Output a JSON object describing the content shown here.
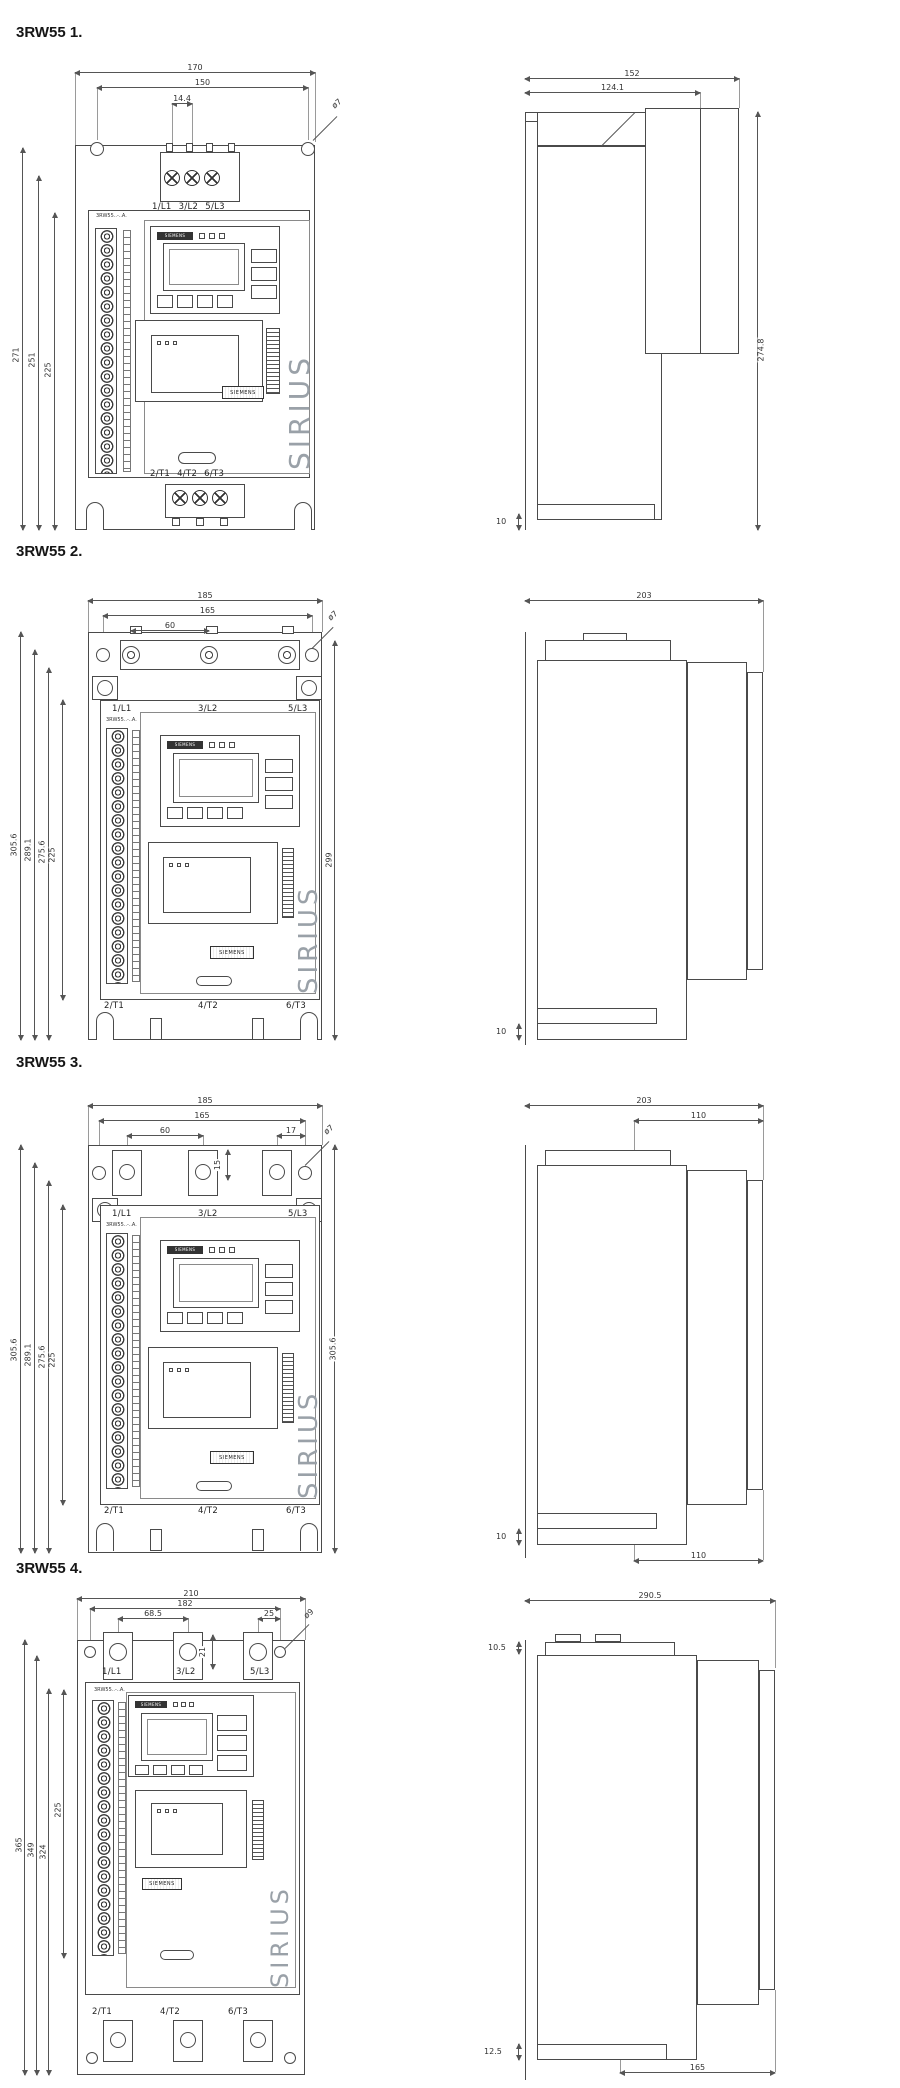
{
  "page": {
    "background": "#ffffff",
    "line_color": "#4a4a4a",
    "dim_text_color": "#333333"
  },
  "drawings": [
    {
      "title": "3RW55 1.",
      "front": {
        "model_label": "3RW55..-..A.",
        "display_brand": "SIEMENS",
        "logo_label": "SIEMENS",
        "product_name": "SIRIUS",
        "top_terminals": [
          "1/L1",
          "3/L2",
          "5/L3"
        ],
        "bottom_terminals": [
          "2/T1",
          "4/T2",
          "6/T3"
        ],
        "dim_width_total": "170",
        "dim_width_holes": "150",
        "dim_terminal_pitch": "14.4",
        "hole_diameter": "ø7",
        "dim_height_total": "271",
        "dim_height_holes": "251",
        "dim_height_body": "225"
      },
      "side": {
        "dim_depth_total": "152",
        "dim_depth_front": "124.1",
        "dim_height": "274.8",
        "dim_foot": "10"
      }
    },
    {
      "title": "3RW55 2.",
      "front": {
        "model_label": "3RW55..-..A.",
        "display_brand": "SIEMENS",
        "logo_label": "SIEMENS",
        "product_name": "SIRIUS",
        "top_terminals": [
          "1/L1",
          "3/L2",
          "5/L3"
        ],
        "bottom_terminals": [
          "2/T1",
          "4/T2",
          "6/T3"
        ],
        "dim_width_total": "185",
        "dim_width_holes": "165",
        "dim_hole_pitch": "60",
        "hole_diameter": "ø7",
        "dim_height_total": "305.6",
        "dim_height_2": "289.1",
        "dim_height_3": "275.6",
        "dim_height_body": "225",
        "dim_height_right": "299"
      },
      "side": {
        "dim_depth_total": "203",
        "dim_foot": "10"
      }
    },
    {
      "title": "3RW55 3.",
      "front": {
        "model_label": "3RW55..-..A.",
        "display_brand": "SIEMENS",
        "logo_label": "SIEMENS",
        "product_name": "SIRIUS",
        "top_terminals": [
          "1/L1",
          "3/L2",
          "5/L3"
        ],
        "bottom_terminals": [
          "2/T1",
          "4/T2",
          "6/T3"
        ],
        "dim_width_total": "185",
        "dim_width_holes": "165",
        "dim_hole_pitch": "60",
        "dim_tab_pitch": "17",
        "dim_tab_depth": "15",
        "hole_diameter": "ø7",
        "dim_height_total": "305.6",
        "dim_height_2": "289.1",
        "dim_height_3": "275.6",
        "dim_height_body": "225",
        "dim_height_right": "305.6"
      },
      "side": {
        "dim_depth_total": "203",
        "dim_depth_front": "110",
        "dim_foot": "10",
        "dim_bottom_front": "110"
      }
    },
    {
      "title": "3RW55 4.",
      "front": {
        "model_label": "3RW55..-..A.",
        "display_brand": "SIEMENS",
        "logo_label": "SIEMENS",
        "product_name": "SIRIUS",
        "top_terminals": [
          "1/L1",
          "3/L2",
          "5/L3"
        ],
        "bottom_terminals": [
          "2/T1",
          "4/T2",
          "6/T3"
        ],
        "dim_width_total": "210",
        "dim_width_holes": "182",
        "dim_hole_pitch": "68.5",
        "dim_tab_pitch": "25",
        "dim_tab_depth": "21",
        "hole_diameter": "ø9",
        "dim_height_total": "365",
        "dim_height_2": "349",
        "dim_height_3": "324",
        "dim_height_body": "225"
      },
      "side": {
        "dim_depth_total": "290.5",
        "dim_top": "10.5",
        "dim_foot": "12.5",
        "dim_bottom_front": "165"
      }
    }
  ]
}
